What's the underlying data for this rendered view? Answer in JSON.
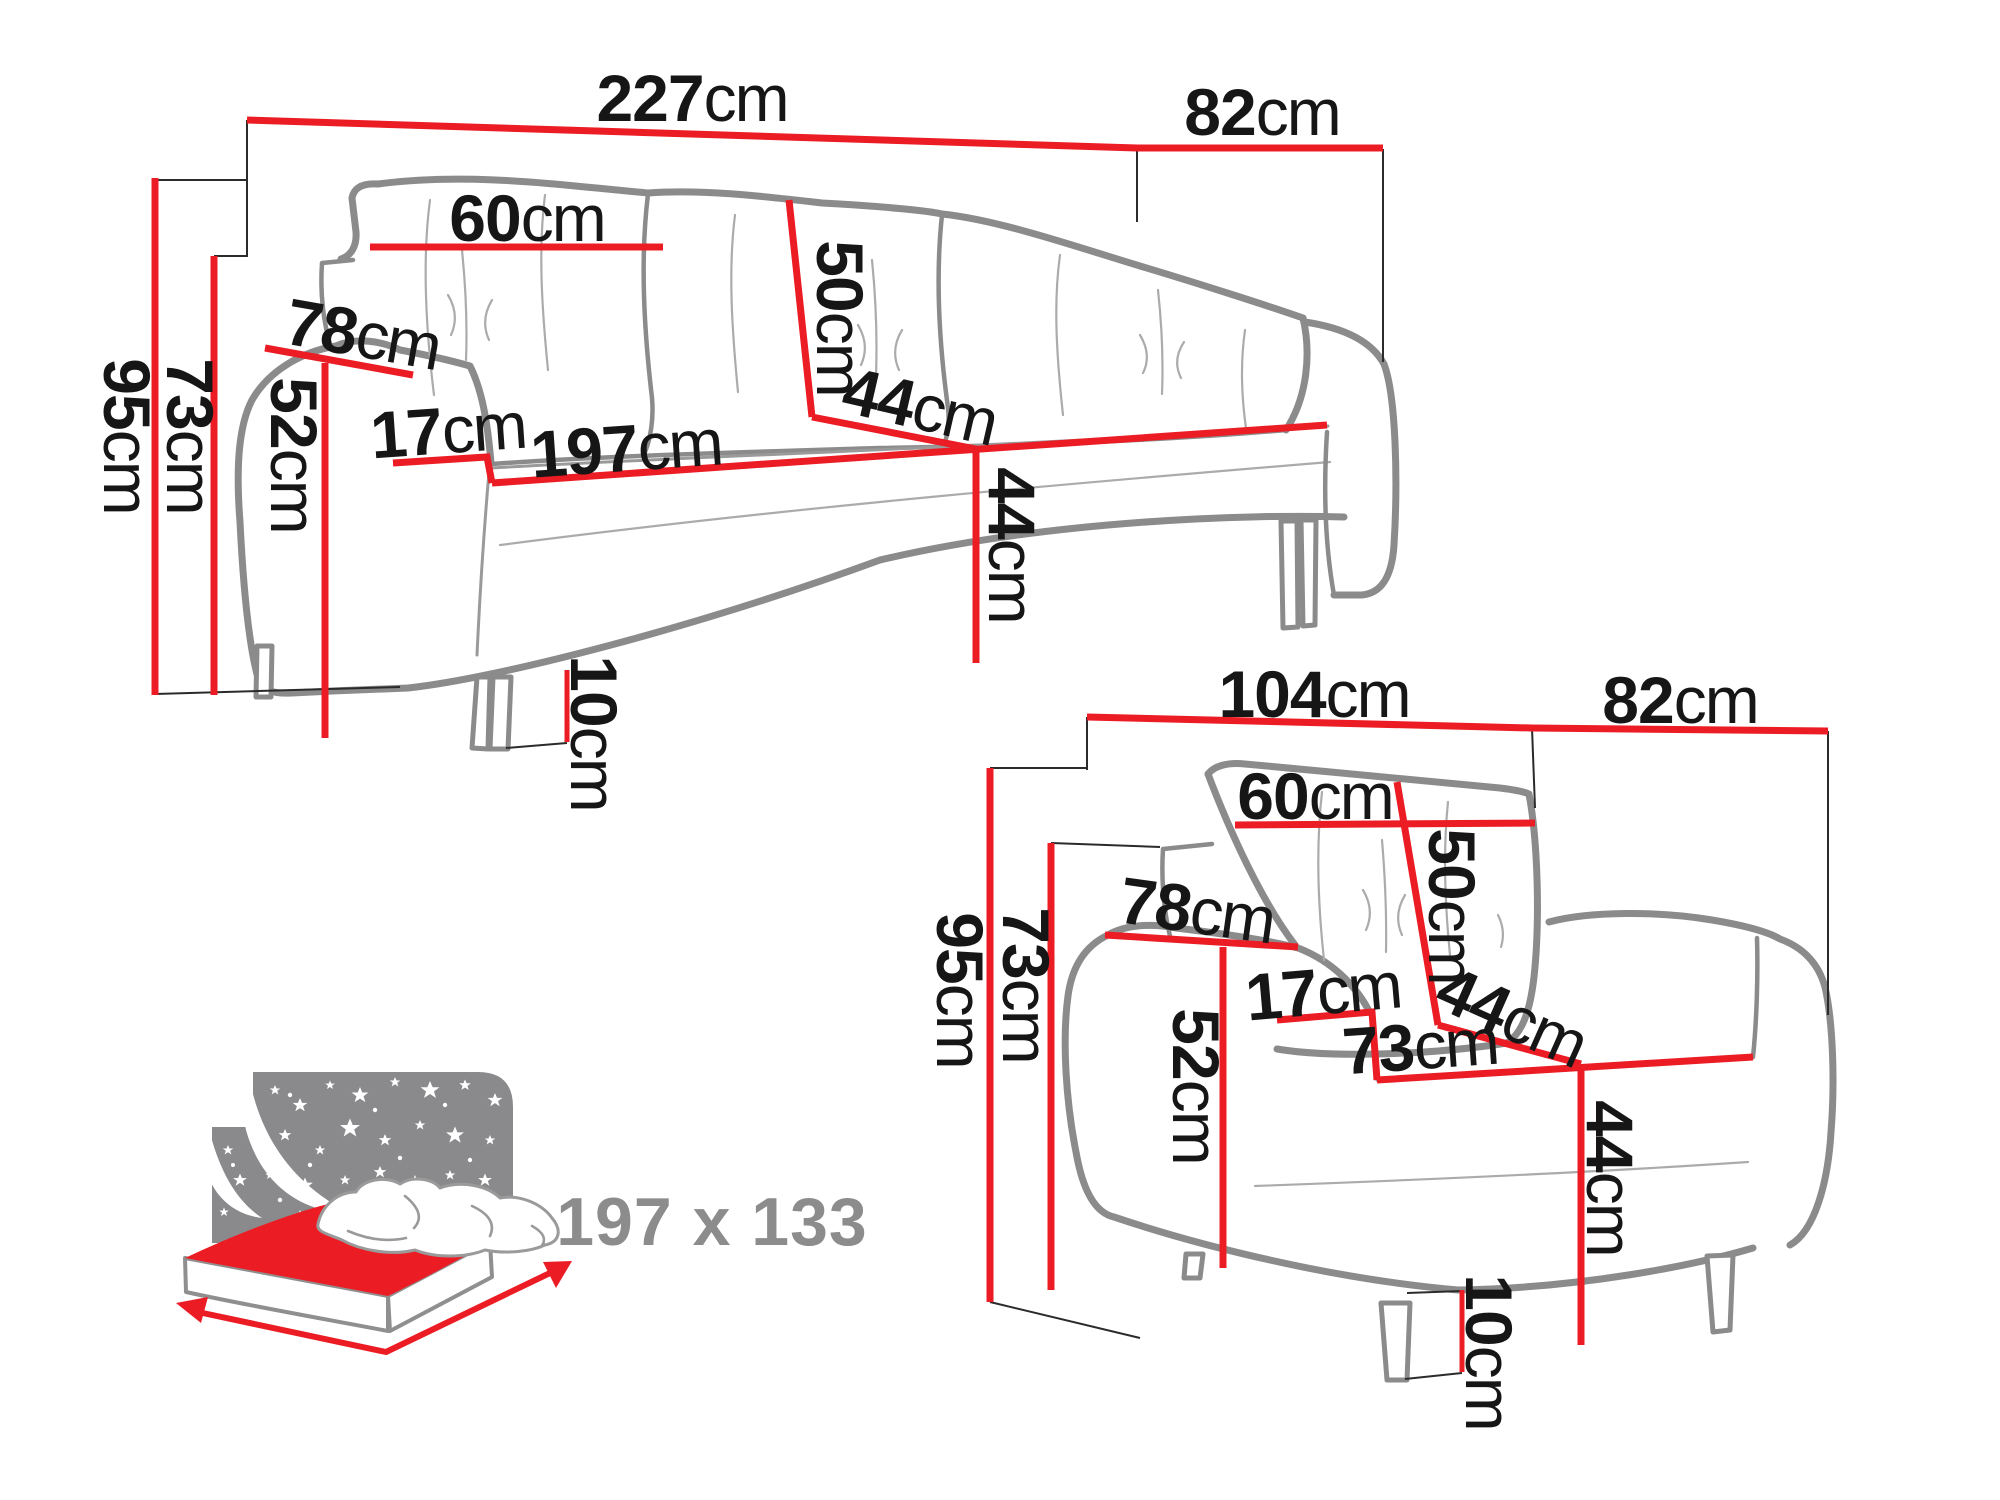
{
  "colors": {
    "dimension_red": "#ec1c24",
    "outline_gray": "#8b8b8b",
    "label_black": "#161616",
    "bed_icon_gray": "#8a8a8d",
    "bed_text_gray": "#8c8c8c",
    "background": "#ffffff"
  },
  "sofa": {
    "name": "three-seat sofa",
    "width": {
      "value": "227",
      "unit": "cm"
    },
    "depth": {
      "value": "82",
      "unit": "cm"
    },
    "height": {
      "value": "95",
      "unit": "cm"
    },
    "back_height": {
      "value": "73",
      "unit": "cm"
    },
    "cushion_width": {
      "value": "60",
      "unit": "cm"
    },
    "cushion_height": {
      "value": "50",
      "unit": "cm"
    },
    "armrest_length": {
      "value": "78",
      "unit": "cm"
    },
    "armrest_width": {
      "value": "17",
      "unit": "cm"
    },
    "armrest_height": {
      "value": "52",
      "unit": "cm"
    },
    "seat_width": {
      "value": "197",
      "unit": "cm"
    },
    "seat_depth": {
      "value": "44",
      "unit": "cm"
    },
    "seat_height": {
      "value": "44",
      "unit": "cm"
    },
    "leg_height": {
      "value": "10",
      "unit": "cm"
    }
  },
  "armchair": {
    "name": "armchair",
    "width": {
      "value": "104",
      "unit": "cm"
    },
    "depth": {
      "value": "82",
      "unit": "cm"
    },
    "height": {
      "value": "95",
      "unit": "cm"
    },
    "back_height": {
      "value": "73",
      "unit": "cm"
    },
    "cushion_width": {
      "value": "60",
      "unit": "cm"
    },
    "cushion_height": {
      "value": "50",
      "unit": "cm"
    },
    "armrest_length": {
      "value": "78",
      "unit": "cm"
    },
    "armrest_width": {
      "value": "17",
      "unit": "cm"
    },
    "armrest_height": {
      "value": "52",
      "unit": "cm"
    },
    "seat_width": {
      "value": "73",
      "unit": "cm"
    },
    "seat_depth": {
      "value": "44",
      "unit": "cm"
    },
    "seat_height": {
      "value": "44",
      "unit": "cm"
    },
    "leg_height": {
      "value": "10",
      "unit": "cm"
    }
  },
  "bed": {
    "name": "fold-out sleeping area",
    "sleeping_area": "197 x 133"
  }
}
